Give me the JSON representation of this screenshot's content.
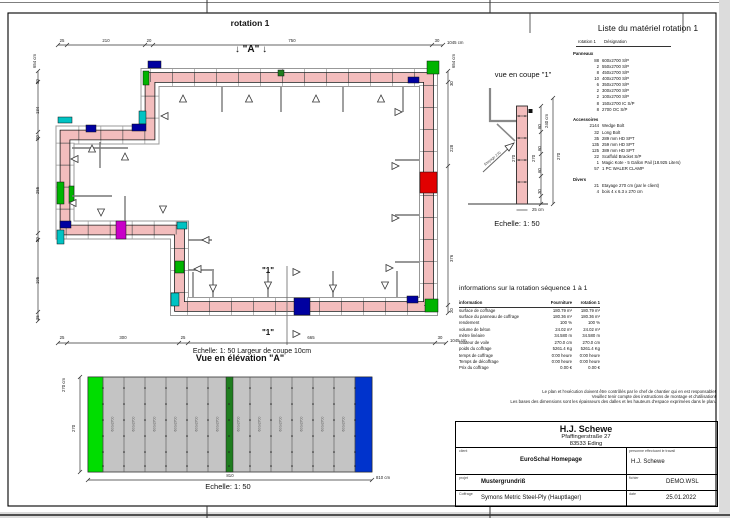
{
  "plan": {
    "title": "rotation 1",
    "marker_a": "↓ \"A\" ↓",
    "marker_1": "\"1\"",
    "scale_caption": "Echelle: 1: 50   Largeur de coupe 10cm",
    "dims": {
      "top": {
        "total": "1045 cm",
        "segments": [
          "25",
          "210",
          "20",
          "750",
          "30"
        ]
      },
      "bottom": {
        "total": "1045 cm",
        "segments": [
          "25",
          "300",
          "25",
          "665",
          "30"
        ]
      },
      "left": {
        "total": "654 cm",
        "segments": [
          "30",
          "134",
          "20",
          "255",
          "20",
          "195",
          "25"
        ]
      },
      "right": {
        "total": "654 cm",
        "segments": [
          "30",
          "228",
          "376",
          "20"
        ]
      }
    }
  },
  "elevation": {
    "title": "Vue en élévation  \"A\"",
    "scale": "Echelle: 1: 50",
    "dim_width": "810",
    "dim_width_unit": "810 cm",
    "dim_height": "270",
    "dim_height_unit": "270 cm",
    "panel_label": "600x2700"
  },
  "section": {
    "title": "vue en coupe \"1\"",
    "scale": "Echelle: 1: 50",
    "dim_right": "240 cm",
    "dim_segments": [
      "60",
      "60",
      "60",
      "30"
    ],
    "dim_total": "270",
    "wall_label": "270",
    "base_width": "25 cm",
    "prop_label": "Etayage 270"
  },
  "material_list": {
    "title": "Liste du matériel  rotation 1",
    "header_qty": "rotation 1",
    "header_designation": "Désignation",
    "groups": [
      {
        "name": "Panneaux",
        "items": [
          {
            "qty": "88",
            "label": "600x2700  S/P"
          },
          {
            "qty": "2",
            "label": "550x2700  S/P"
          },
          {
            "qty": "8",
            "label": "450x2700  S/P"
          },
          {
            "qty": "10",
            "label": "400x2700  S/P"
          },
          {
            "qty": "6",
            "label": "350x2700  S/P"
          },
          {
            "qty": "2",
            "label": "300x2700  S/P"
          },
          {
            "qty": "2",
            "label": "100x2700  S/P"
          },
          {
            "qty": "8",
            "label": "150x2700  IC S/P"
          },
          {
            "qty": "8",
            "label": "2700  OC S/P"
          }
        ]
      },
      {
        "name": "Accessoires",
        "items": [
          {
            "qty": "2144",
            "label": "Wedge Bolt"
          },
          {
            "qty": "32",
            "label": "Long Bolt"
          },
          {
            "qty": "35",
            "label": "289 mm HD SPT"
          },
          {
            "qty": "135",
            "label": "259 mm HD SPT"
          },
          {
            "qty": "125",
            "label": "389 mm HD SPT"
          },
          {
            "qty": "22",
            "label": "Scaffold Bracket S/P"
          },
          {
            "qty": "1",
            "label": "Magic Kote - 5 Gallon Pail (18.925 Liters)"
          },
          {
            "qty": "57",
            "label": "1 PC WALER CLAMP"
          }
        ]
      },
      {
        "name": "Divers",
        "items": [
          {
            "qty": "21",
            "label": "Etayage 270 cm (par le client)"
          },
          {
            "qty": "4",
            "label": "bois 4 x 6.3 x 270 cm"
          }
        ]
      }
    ]
  },
  "info_table": {
    "title": "informations sur la rotation  séquence 1 à 1",
    "columns": [
      "information",
      "Fourniture",
      "rotation 1"
    ],
    "rows": [
      [
        "surface de coffrage",
        "180.79 m²",
        "180.79 m²"
      ],
      [
        "surface du panneau de coffrage",
        "180.36 m²",
        "180.36 m²"
      ],
      [
        "rendement",
        "100 %",
        "100 %"
      ],
      [
        "volume de béton",
        "24.02 m³",
        "24.02 m³"
      ],
      [
        "mètre linéaire",
        "34.580 m",
        "34.580 m"
      ],
      [
        "hauteur de voile",
        "270.0 cm",
        "270.0 cm"
      ],
      [
        "poids du coffrage",
        "5261.4 Kg",
        "5261.4 Kg"
      ],
      [
        "temps de coffrage",
        "0:00 heure",
        "0:00 heure"
      ],
      [
        "Temps de décoffrage",
        "0:00 heure",
        "0:00 heure"
      ],
      [
        "Prix du coffrage",
        "0.00 €",
        "0.00 €"
      ]
    ]
  },
  "disclaimer": [
    "Le plan et l'exécution doivent être contrôlés par le chef de chantier qui en est responsable!",
    "Veuillez tenir compte des instructions de montage et d'utilisation!",
    "Les bases des dimensions sont les épaisseurs des dalles et les hauteurs d'espace exprimées dans le plan."
  ],
  "title_block": {
    "company": "H.J. Schewe",
    "address_line1": "Pfaffingerstraße 27",
    "address_line2": "83533 Eding",
    "client_label": "client",
    "client_value": "EuroSchal Homepage",
    "worker_label": "personne effectuant le travail",
    "worker_value": "H.J. Schewe",
    "project_label": "projet",
    "project_value": "Mustergrundriß",
    "file_label": "fichier",
    "file_value": "DEMO.WSL",
    "formwork_label": "Coffrage",
    "formwork_value": "Symons Metric Steel-Ply (Hauptlager)",
    "date_label": "date",
    "date_value": "25.01.2022"
  },
  "colors": {
    "wall_pink": "#f3bdbd",
    "panel_gray": "#989898",
    "corner_blue": "#0000a0",
    "corner_cyan": "#00c3c3",
    "corner_green": "#00b400",
    "corner_dark_green": "#1e7d1e",
    "corner_magenta": "#c800c8",
    "stop_red": "#e10000",
    "elev_panel": "#c4c4c4",
    "elev_green": "#00dd00",
    "elev_blue": "#0033cc"
  }
}
